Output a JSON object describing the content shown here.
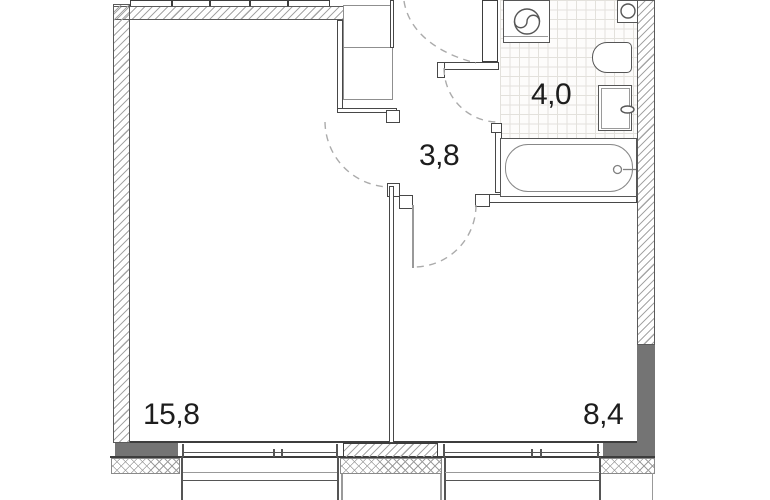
{
  "floor_plan": {
    "rooms": [
      {
        "name": "living-room",
        "area_label": "15,8"
      },
      {
        "name": "hallway",
        "area_label": "3,8"
      },
      {
        "name": "bathroom",
        "area_label": "4,0"
      },
      {
        "name": "bedroom",
        "area_label": "8,4"
      }
    ],
    "fixtures": [
      {
        "name": "washing-machine-icon"
      },
      {
        "name": "washbasin-icon"
      },
      {
        "name": "toilet-icon"
      },
      {
        "name": "vanity-sink-icon"
      },
      {
        "name": "bathtub-icon"
      },
      {
        "name": "wardrobe-icon"
      }
    ],
    "colors": {
      "background": "#ffffff",
      "wall_outline": "#3d3d3d",
      "solid_wall_fill": "#747474",
      "hatch_line": "#a6a6a6",
      "tile_grid": "#e3e1dc",
      "door_arc": "#ababab",
      "label_text": "#1d1d1d"
    }
  }
}
